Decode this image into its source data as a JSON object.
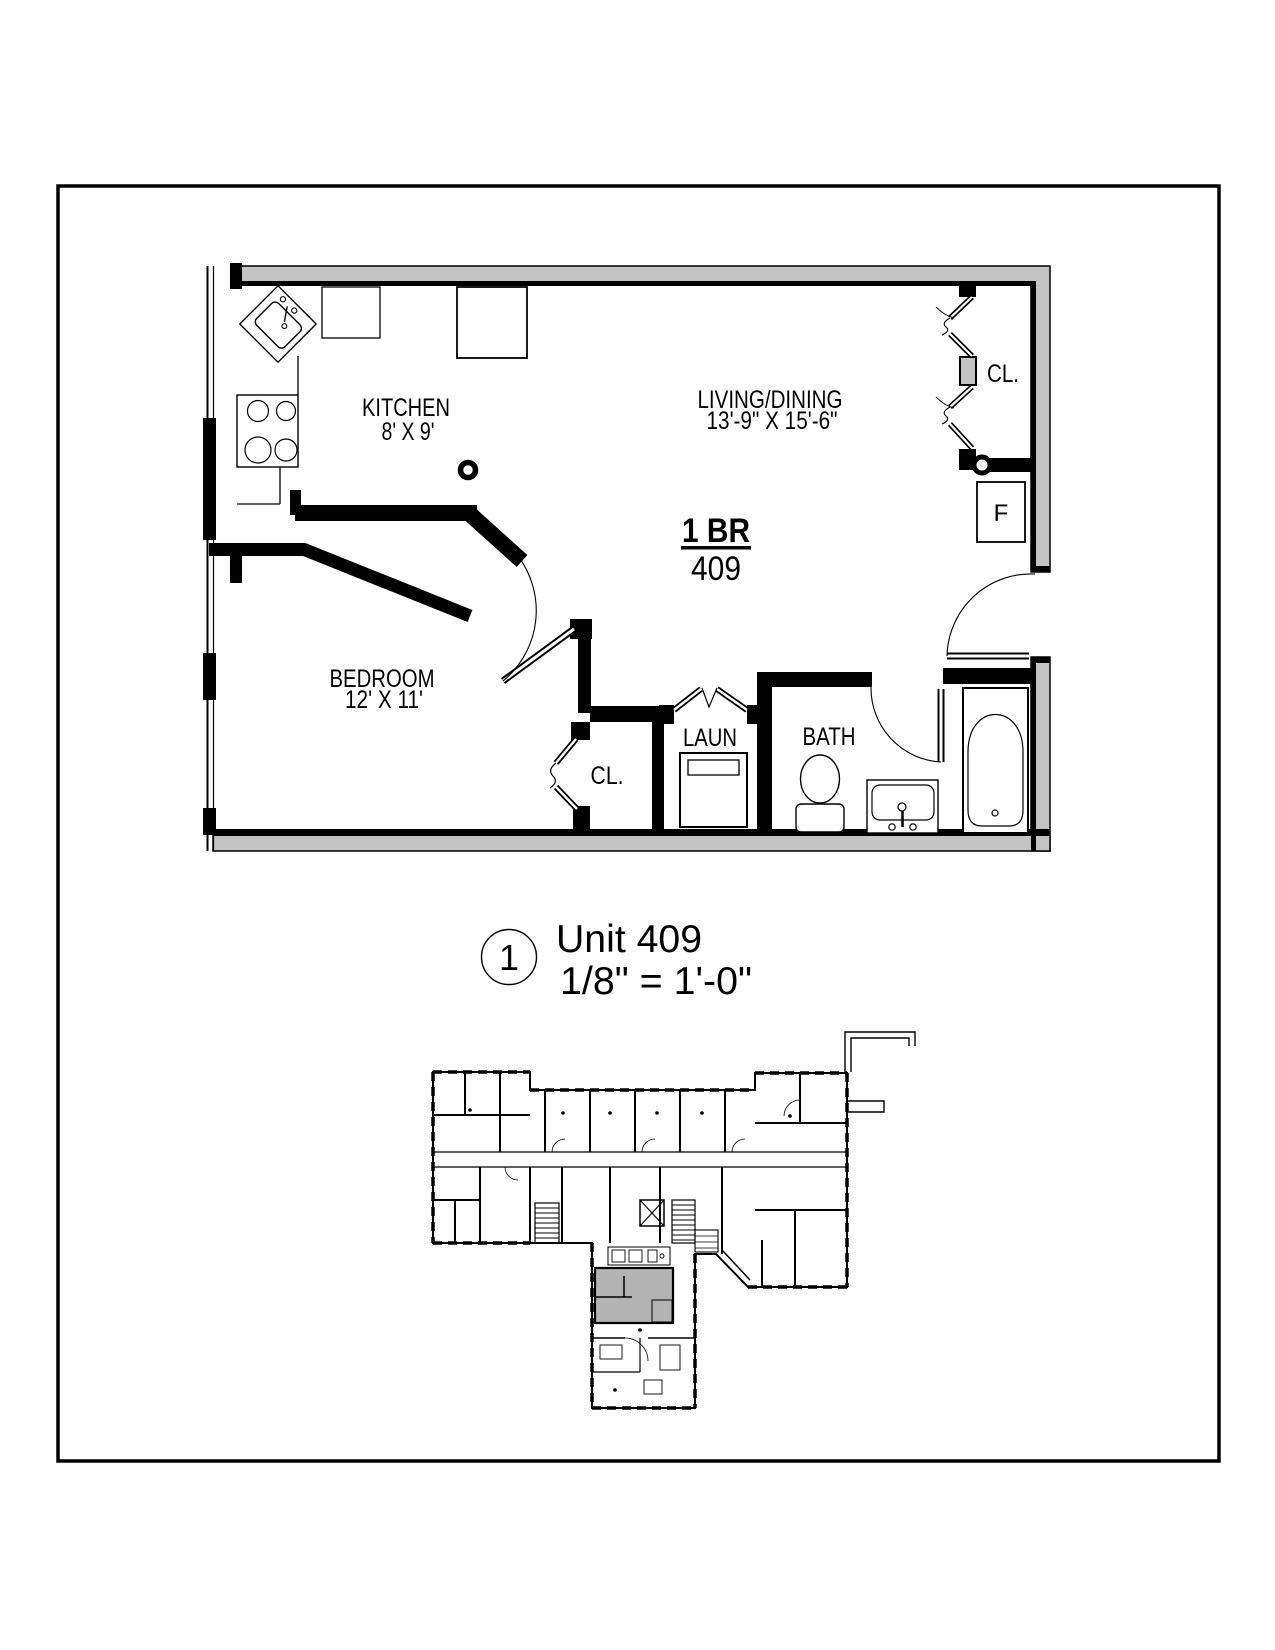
{
  "drawing": {
    "unit_type_label": "1 BR",
    "unit_number": "409",
    "rooms": {
      "kitchen": {
        "name": "KITCHEN",
        "dims": "8' X 9'"
      },
      "living_dining": {
        "name": "LIVING/DINING",
        "dims": "13'-9\" X 15'-6\""
      },
      "bedroom": {
        "name": "BEDROOM",
        "dims": "12' X 11'"
      },
      "bath": {
        "name": "BATH"
      },
      "laundry": {
        "name": "LAUN"
      },
      "closet_living": {
        "name": "CL."
      },
      "closet_bedroom": {
        "name": "CL."
      }
    },
    "appliances": {
      "refrigerator_label": "F"
    }
  },
  "title_block": {
    "detail_number": "1",
    "detail_title": "Unit 409",
    "scale": "1/8\" = 1'-0\""
  },
  "colors": {
    "wall_poche": "#c3c3c3",
    "key_plan_highlight": "#b3b3b3",
    "line": "#000000"
  }
}
